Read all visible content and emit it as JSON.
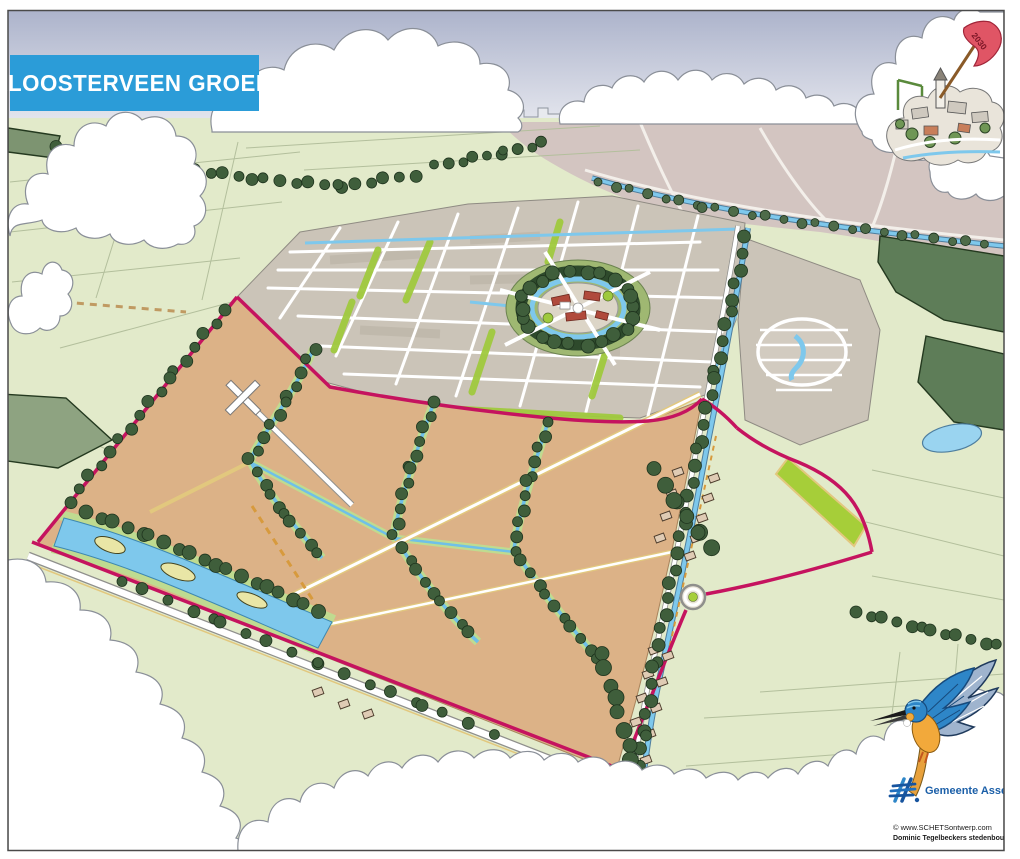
{
  "banner": {
    "text": "“KLOOSTERVEEN GROEIT”",
    "background": "#2B9CD8",
    "text_color": "#FFFFFF"
  },
  "flag": {
    "year": "2030",
    "color": "#E05565"
  },
  "branding": {
    "municipality": "Gemeente Assen",
    "logo_color": "#1B5FA8",
    "credit_line1": "© www.SCHETSontwerp.com",
    "credit_line2": "Dominic Tegelbeckers stedenbouw &architectuur"
  },
  "palette": {
    "sky_top": "#ACB3CB",
    "sky_bottom": "#EDEEF3",
    "farmland_green": "#E2EACA",
    "expansion_fields_tan": "#DCB287",
    "urban_fabric_gray": "#CBC4B8",
    "distant_city_mauve": "#D3C5C1",
    "water_blue": "#7EC8EC",
    "park_green": "#9FC93D",
    "forest_green": "#5E7D58",
    "tree_green": "#3F5E3B",
    "ring_road_magenta": "#C5135F",
    "path_yellow": "#E2C87E",
    "cloud_white": "#FFFFFF"
  }
}
